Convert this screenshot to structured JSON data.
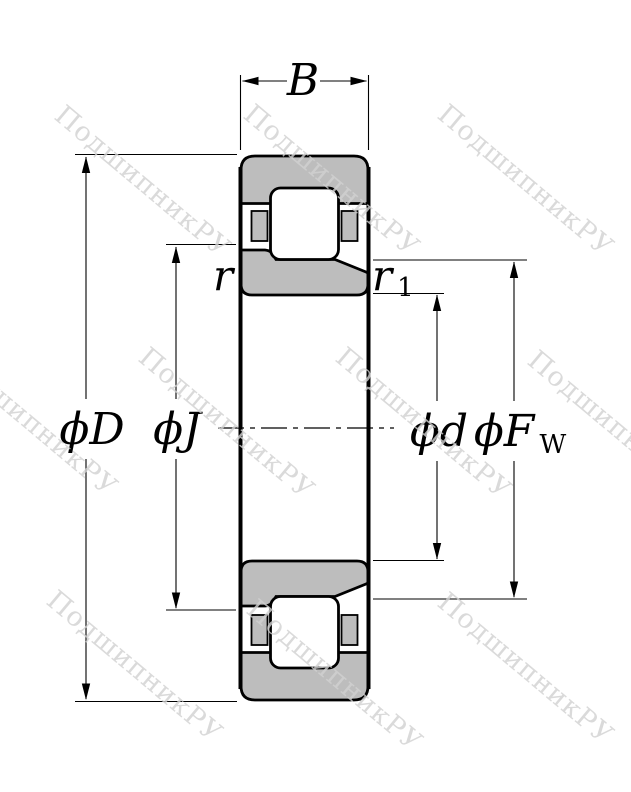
{
  "figure": {
    "type": "cylindrical-roller-bearing-cross-section-drawing",
    "colors": {
      "background": "#ffffff",
      "ring_fill": "#bdbdbd",
      "line": "#000000",
      "watermark": "#d2d2d2"
    },
    "watermark": {
      "text": "ПодшипникРУ"
    },
    "labels": {
      "width": "B",
      "outer_diameter": "ϕD",
      "flange_diameter": "ϕJ",
      "bore_diameter": "ϕd",
      "raceway_main": "ϕF",
      "raceway_sub": "W",
      "chamfer_r": "r",
      "chamfer_r1_main": "r",
      "chamfer_r1_sub": "1"
    }
  }
}
